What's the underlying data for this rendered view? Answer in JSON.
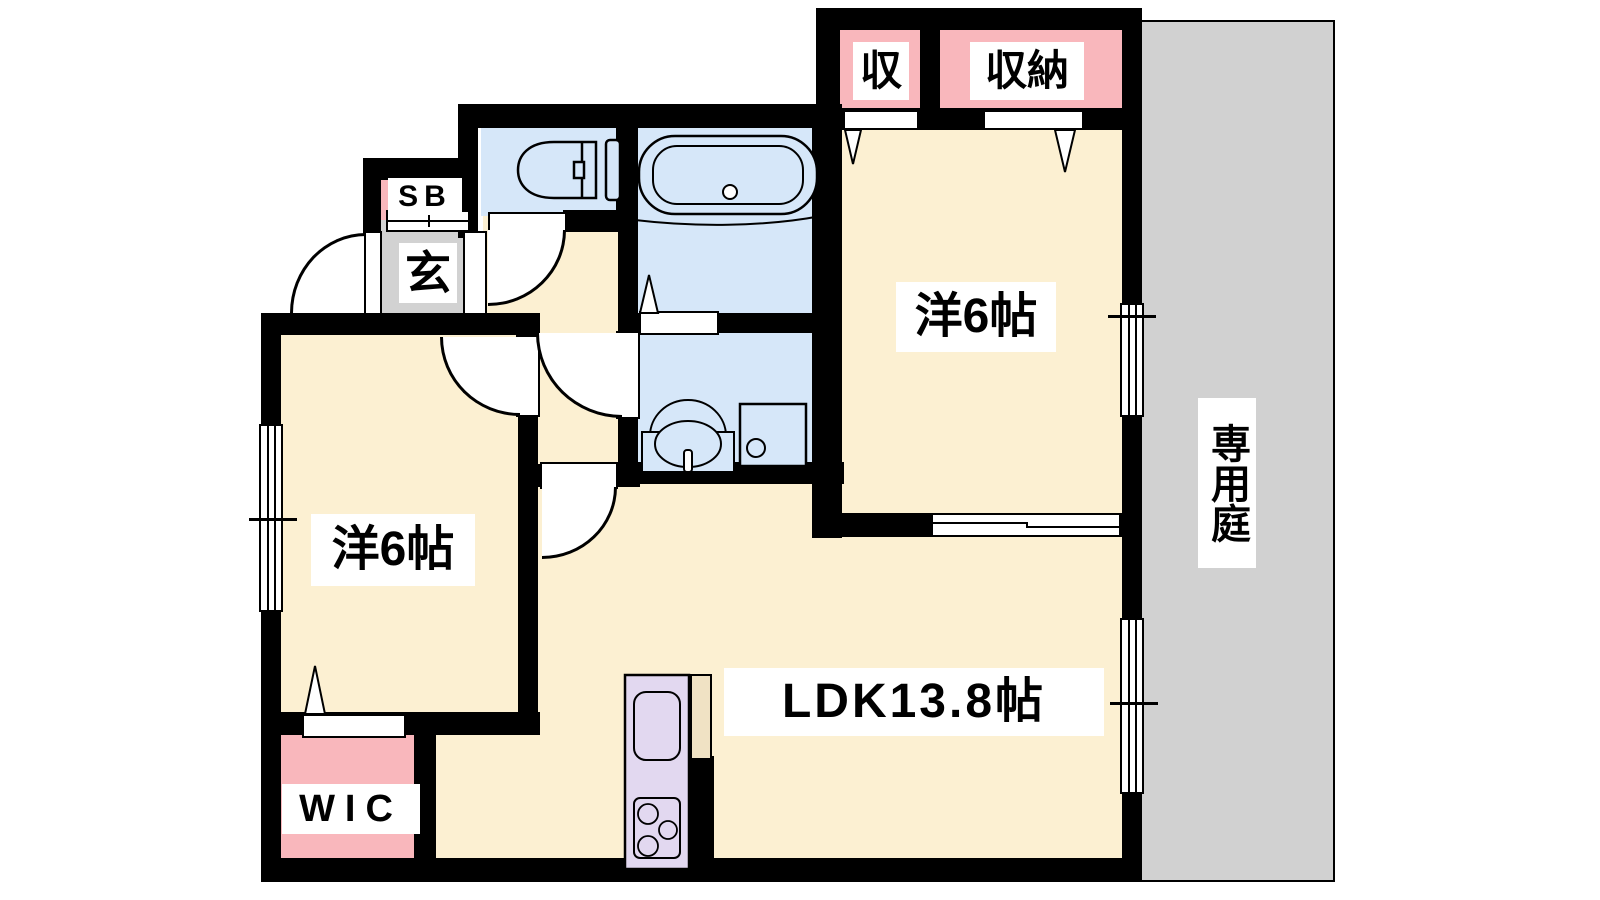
{
  "title": "2LDK apartment floor plan",
  "labels": {
    "closet_small": "収",
    "closet_large": "収納",
    "bedroom_right": "洋6帖",
    "bedroom_left": "洋6帖",
    "ldk": "LDK13.8帖",
    "wic": "WIC",
    "shoe_box": "SB",
    "entrance": "玄",
    "garden": "専用庭"
  },
  "colors": {
    "room_floor": "#FCF0D2",
    "closet_pink": "#F9B7BC",
    "water_blue": "#D6E7F9",
    "garden_gray": "#D1D1D1",
    "entrance_gray": "#D2D2D2",
    "kitchen_lavender": "#E2D8F0",
    "counter_tan": "#F0E2C4",
    "wall": "#000000"
  }
}
